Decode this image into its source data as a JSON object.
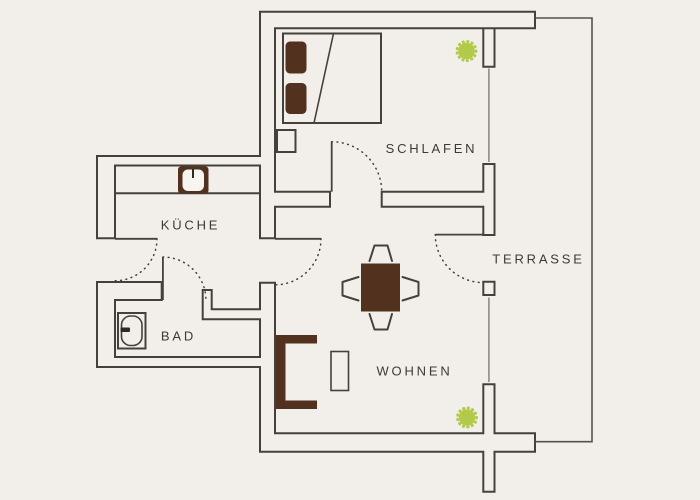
{
  "floorplan": {
    "title": "apartment-floor-plan",
    "rooms": {
      "schlafen": {
        "label": "SCHLAFEN"
      },
      "kueche": {
        "label": "KÜCHE"
      },
      "bad": {
        "label": "BAD"
      },
      "wohnen": {
        "label": "WOHNEN"
      },
      "terrasse": {
        "label": "TERRASSE"
      }
    },
    "colors": {
      "background": "#f2efea",
      "wall_line": "#45413a",
      "terrace_line": "#55514a",
      "window_line": "#9a968e",
      "furniture_brown": "#53311f",
      "sink_interior": "#f7f5f0",
      "faucet_dark": "#2e2a26",
      "plant_green": "#b2c94a",
      "label_text": "#3d3a35"
    },
    "furniture_icons": [
      "bed",
      "bed-pillow",
      "blanket-line",
      "nightstand",
      "kitchen-sink",
      "kitchen-counter",
      "bathtub",
      "faucet",
      "dining-table",
      "chair",
      "sofa",
      "side-table",
      "plant"
    ]
  }
}
